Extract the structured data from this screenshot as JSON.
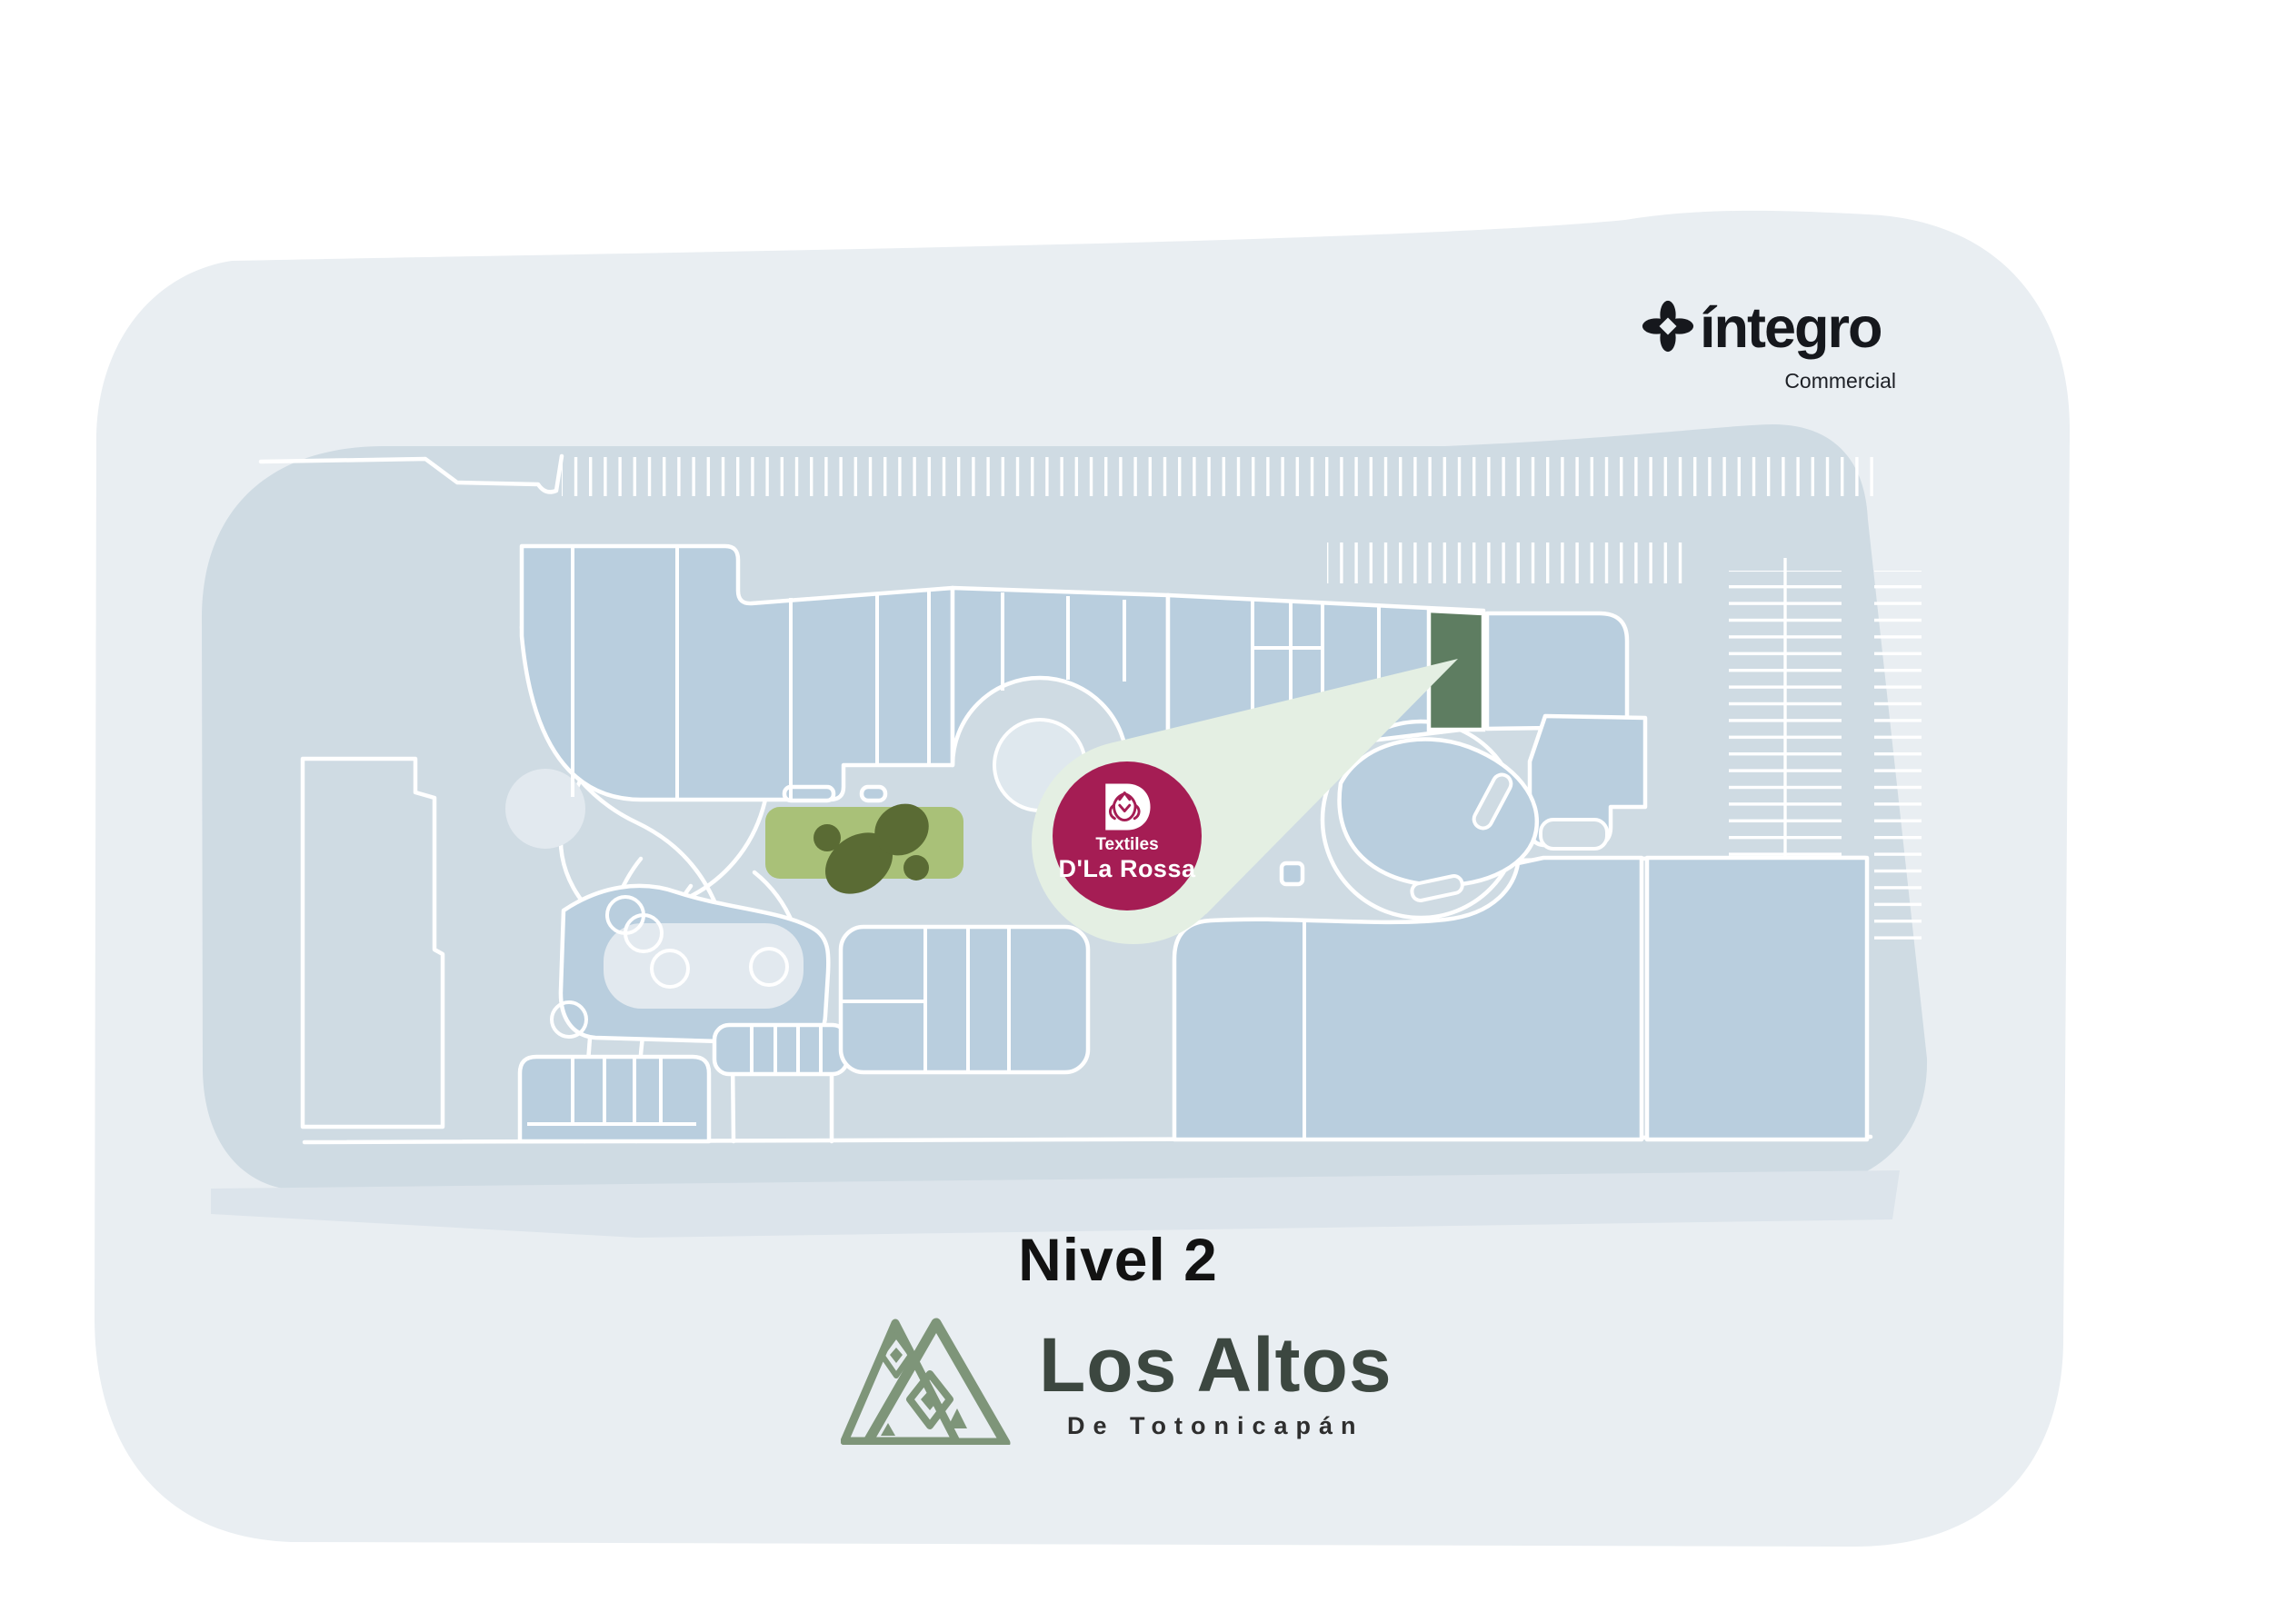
{
  "header": {
    "brand": {
      "name": "íntegro",
      "tagline": "Commercial",
      "icon": "sparkle-diamond-icon",
      "color": "#16181d"
    }
  },
  "map": {
    "level_label": "Nivel 2",
    "badge": {
      "icon": "rose-d-monogram-icon",
      "line1": "Textiles",
      "line2": "D'La Rossa"
    },
    "highlighted_store": {
      "name": "Textiles D'La Rossa",
      "marker_color": "#a51d54",
      "store_fill": "#5e7d61",
      "callout_color": "#e4efe3"
    },
    "colors": {
      "outer_area": "#e9eef2",
      "site_base": "#cfdbe3",
      "buildings": "#b9cede",
      "walkway_lines": "#ffffff",
      "park_green": "#a9c178",
      "park_trees": "#5a6b34",
      "plaza_light": "#e2e9ef"
    }
  },
  "footer": {
    "logo": {
      "title": "Los Altos",
      "subtitle": "De Totonicapán",
      "icon": "mountains-icon",
      "color": "#7e9579"
    }
  }
}
